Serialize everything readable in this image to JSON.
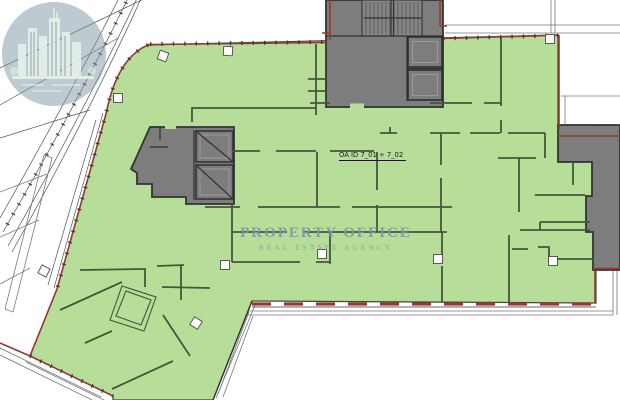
{
  "plan": {
    "description": "architectural-floor-plan",
    "highlighted_unit": "office floor area"
  },
  "labels": {
    "unit_id": "OA ID 7_01 ÷ 7_02"
  },
  "watermark": {
    "line1": "PROPERTY OFFICE",
    "line2": "REAL ESTATE AGENCY",
    "logo": "building-skyline-icon"
  },
  "colors": {
    "highlight_green": "#b7de99",
    "interior_wall": "#45563c",
    "core_gray": "#7d7d7d",
    "core_border": "#333333",
    "exterior_red": "#943a31",
    "watermark_blue": "#7d96a4",
    "column_fill": "#ffffff"
  }
}
